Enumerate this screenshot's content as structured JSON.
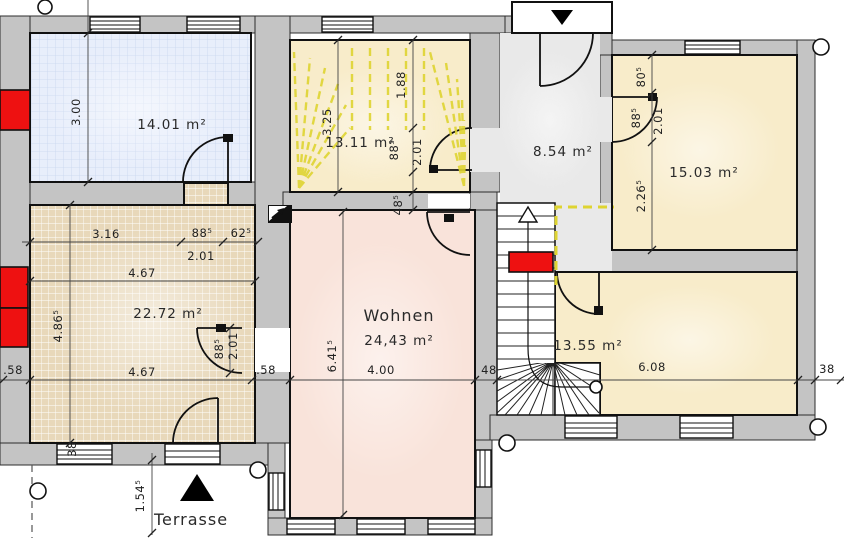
{
  "plan": {
    "rooms": [
      {
        "key": "room-top-left",
        "area": "14.01 m²"
      },
      {
        "key": "room-stairwell",
        "area": "13.11 m²"
      },
      {
        "key": "room-hall",
        "area": "8.54 m²"
      },
      {
        "key": "room-top-right",
        "area": "15.03 m²"
      },
      {
        "key": "room-mid-left",
        "area": "22.72 m²"
      },
      {
        "key": "room-living",
        "name": "Wohnen",
        "area": "24,43 m²"
      },
      {
        "key": "room-bottom-right",
        "area": "13.55 m²"
      },
      {
        "key": "terrace",
        "name": "Terrasse"
      }
    ],
    "dims": {
      "v300": "3.00",
      "v325": "3.25",
      "v188": "1.88",
      "v885_stair": "88⁵",
      "v201_stair": "2.01",
      "v485_wall": "48⁵",
      "v805": "80⁵",
      "v885_right": "88⁵",
      "v201_right": "2.01",
      "v2265": "2.26⁵",
      "h316": "3.16",
      "h885": "88⁵",
      "h625": "62⁵",
      "h201": "2.01",
      "h467_top": "4.67",
      "h467_bottom": "4.67",
      "v4865": "4.86⁵",
      "v885_door": "88⁵",
      "v201_door": "2.01",
      "h58_left": ".58",
      "h58_mid": ".58",
      "h400": "4.00",
      "h48": "48",
      "h608": "6.08",
      "h38": "38",
      "v38": "38",
      "v6415": "6.41⁵",
      "v1545": "1.54⁵"
    },
    "colors": {
      "wall": "#c4c4c4",
      "cream": "#f8ecca",
      "pink": "#f9e3da",
      "hall": "#e9e9e9",
      "blue_bg": "#e8eefb",
      "blue_line": "#c8d6ef",
      "tan_bg": "#e8d8ba",
      "tan_line": "#ffffff",
      "red": "#ee1111",
      "dash": "#ded431"
    }
  }
}
